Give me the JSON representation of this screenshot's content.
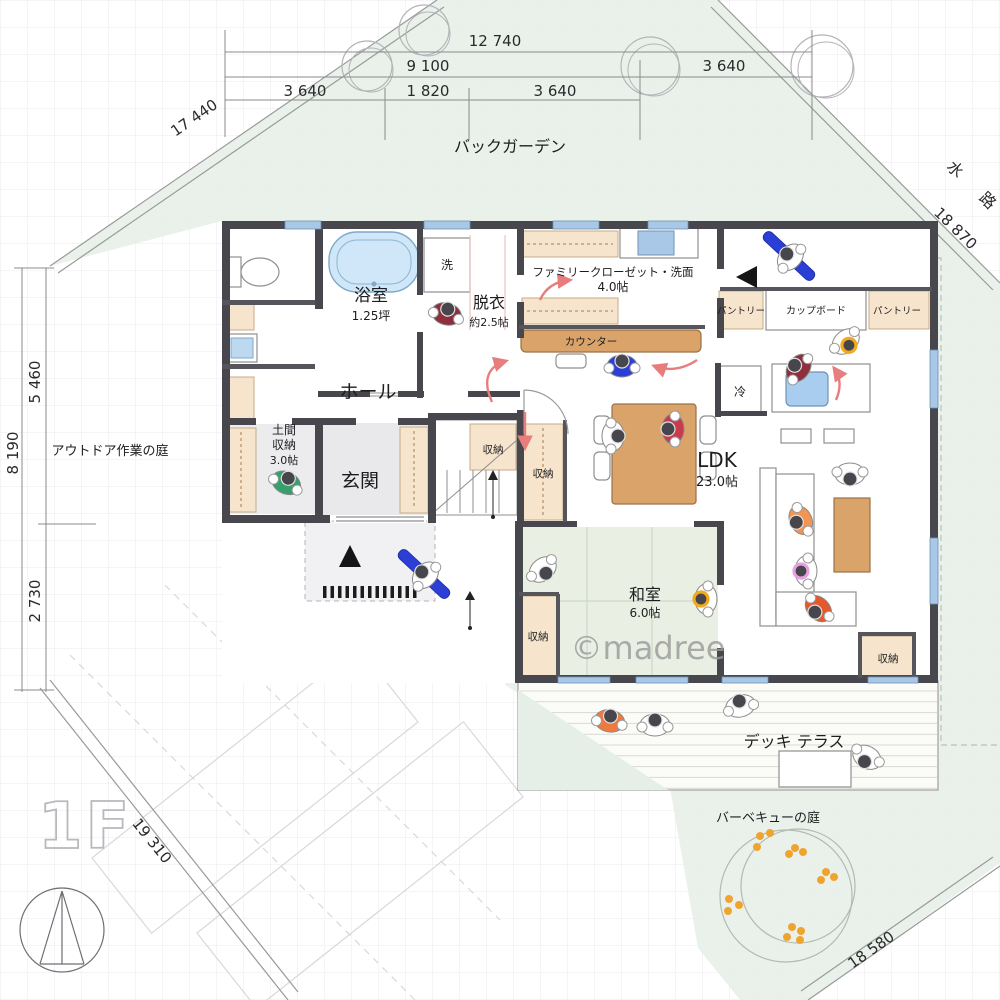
{
  "floor_label": "1F",
  "watermark": "©madree",
  "site": {
    "back_garden": "バックガーデン",
    "outdoor_garden": "アウトドア作業の庭",
    "deck": "デッキ テラス",
    "bbq_garden": "バーベキューの庭",
    "waterway": "水 路"
  },
  "rooms": {
    "bathroom": {
      "name": "浴室",
      "size": "1.25坪"
    },
    "laundry": "洗",
    "dressing": {
      "name": "脱衣",
      "size": "約2.5帖"
    },
    "family_closet": {
      "name": "ファミリークローゼット・洗面",
      "size": "4.0帖"
    },
    "counter": "カウンター",
    "pantry_left": "パントリー",
    "cupboard": "カップボード",
    "pantry_right": "パントリー",
    "fridge": "冷",
    "hall": "ホール",
    "doma_storage": {
      "line1": "土間",
      "line2": "収納",
      "size": "3.0帖"
    },
    "entrance": "玄関",
    "storage_stair": "収納",
    "storage_stair2": "収納",
    "ldk": {
      "name": "LDK",
      "size": "23.0帖"
    },
    "washitsu": {
      "name": "和室",
      "size": "6.0帖"
    },
    "storage_washitsu": "収納",
    "storage_south": "収納"
  },
  "dimensions": {
    "top_total": "12 740",
    "top_mid": "9 100",
    "top_right": "3 640",
    "top_a": "3 640",
    "top_b": "1 820",
    "top_c": "3 640",
    "diag_top_left": "17 440",
    "diag_top_right": "18 870",
    "left_outer": "8 190",
    "left_upper": "5 460",
    "left_lower": "2 730",
    "diag_bottom_left": "19 310",
    "diag_bottom_right": "18 580"
  },
  "colors": {
    "wall": "#47474d",
    "site_green": "#e6efe7",
    "tatami": "#e9efe3",
    "wood": "#d9a36a",
    "closet_tan": "#f6e4cc",
    "window_blue": "#a9c7e7",
    "tub_blue": "#cfe7f8",
    "arrow_red": "#e87d7d",
    "person_blue": "#2b3fd6",
    "dot_orange": "#f0a430"
  },
  "people": [
    {
      "x": 447,
      "y": 312,
      "rot": 15,
      "shirt": "#8d2f3c"
    },
    {
      "x": 287,
      "y": 481,
      "rot": 25,
      "shirt": "#35a06c"
    },
    {
      "x": 424,
      "y": 574,
      "rot": -47,
      "shirt": "#ffffff",
      "bar": "#2b3fd6"
    },
    {
      "x": 789,
      "y": 256,
      "rot": -47,
      "shirt": "#ffffff",
      "bar": "#2b3fd6"
    },
    {
      "x": 622,
      "y": 364,
      "rot": 0,
      "shirt": "#2b3fd6"
    },
    {
      "x": 797,
      "y": 367,
      "rot": -55,
      "shirt": "#8d2f3c"
    },
    {
      "x": 847,
      "y": 343,
      "rot": 140,
      "shirt": "#ffffff",
      "ring": "#f2a91c"
    },
    {
      "x": 615,
      "y": 436,
      "rot": 90,
      "shirt": "#ffffff"
    },
    {
      "x": 671,
      "y": 429,
      "rot": -90,
      "shirt": "#c93a4c"
    },
    {
      "x": 850,
      "y": 476,
      "rot": 180,
      "shirt": "#ffffff"
    },
    {
      "x": 799,
      "y": 521,
      "rot": -115,
      "shirt": "#f29550"
    },
    {
      "x": 804,
      "y": 571,
      "rot": -90,
      "shirt": "#ffffff",
      "ring": "#e79fe2"
    },
    {
      "x": 817,
      "y": 610,
      "rot": -135,
      "shirt": "#e2592e"
    },
    {
      "x": 704,
      "y": 599,
      "rot": -90,
      "shirt": "#ffffff",
      "ring": "#f2a91c"
    },
    {
      "x": 544,
      "y": 571,
      "rot": 140,
      "shirt": "#ffffff"
    },
    {
      "x": 610,
      "y": 719,
      "rot": 10,
      "shirt": "#f07a3e"
    },
    {
      "x": 655,
      "y": 723,
      "rot": 0,
      "shirt": "#ffffff"
    },
    {
      "x": 740,
      "y": 704,
      "rot": -15,
      "shirt": "#ffffff"
    },
    {
      "x": 866,
      "y": 759,
      "rot": -150,
      "shirt": "#ffffff"
    }
  ],
  "trees": [
    [
      367,
      66,
      25
    ],
    [
      424,
      30,
      25
    ],
    [
      650,
      66,
      29
    ],
    [
      822,
      66,
      31
    ]
  ],
  "bbq_dots": [
    [
      760,
      836
    ],
    [
      770,
      833
    ],
    [
      757,
      847
    ],
    [
      795,
      848
    ],
    [
      803,
      852
    ],
    [
      789,
      854
    ],
    [
      826,
      872
    ],
    [
      834,
      877
    ],
    [
      821,
      880
    ],
    [
      729,
      899
    ],
    [
      739,
      905
    ],
    [
      728,
      911
    ],
    [
      792,
      927
    ],
    [
      801,
      931
    ],
    [
      787,
      937
    ],
    [
      800,
      940
    ]
  ],
  "windows": [
    [
      285,
      221,
      36,
      8
    ],
    [
      424,
      221,
      46,
      8
    ],
    [
      553,
      221,
      46,
      8
    ],
    [
      648,
      221,
      40,
      8
    ],
    [
      930,
      350,
      8,
      58
    ],
    [
      930,
      538,
      8,
      66
    ],
    [
      558,
      677,
      52,
      6
    ],
    [
      636,
      677,
      52,
      6
    ],
    [
      722,
      677,
      46,
      6
    ],
    [
      868,
      677,
      50,
      6
    ]
  ]
}
